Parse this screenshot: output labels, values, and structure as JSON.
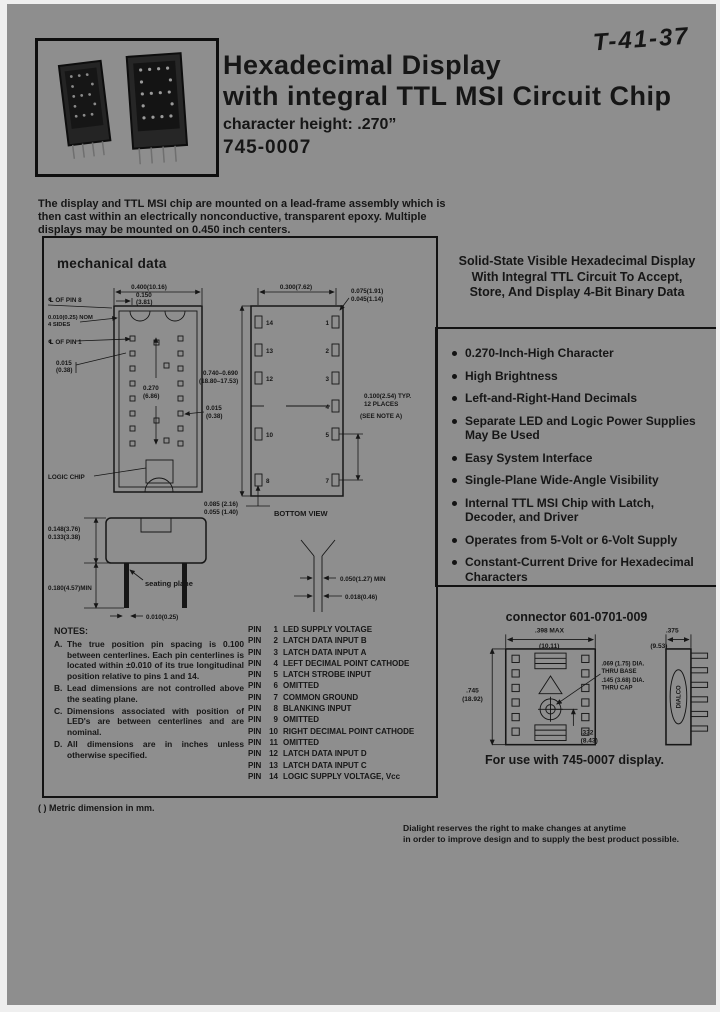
{
  "page": {
    "handwritten_note": "T-41-37",
    "title_line1": "Hexadecimal Display",
    "title_line2": "with integral TTL MSI Circuit Chip",
    "subtitle": "character height: .270”",
    "part_number": "745-0007",
    "intro": "The display and TTL MSI chip are mounted on a lead-frame assembly which is then cast within an electrically nonconductive, transparent epoxy. Multiple displays may be mounted on 0.450 inch centers.",
    "metric_note": "( ) Metric dimension in mm.",
    "disclaimer_line1": "Dialight reserves the right to make changes at anytime",
    "disclaimer_line2": "in order to improve design and to supply the best product possible."
  },
  "headline": {
    "line1": "Solid-State Visible Hexadecimal Display",
    "line2": "With Integral TTL Circuit To Accept,",
    "line3": "Store, And Display 4-Bit Binary Data"
  },
  "features": [
    "0.270-Inch-High Character",
    "High Brightness",
    "Left-and-Right-Hand Decimals",
    "Separate LED and Logic Power Supplies May Be Used",
    "Easy System Interface",
    "Single-Plane Wide-Angle Visibility",
    "Internal TTL MSI Chip with Latch, Decoder, and Driver",
    "Operates from 5-Volt or 6-Volt Supply",
    "Constant-Current Drive for Hexadecimal Characters"
  ],
  "mechanical": {
    "heading": "mechanical data",
    "pin_word": "PIN",
    "front": {
      "dim_width": "0.400(10.16)",
      "dim_offset": "0.150",
      "dim_offset_mm": "(3.81)",
      "cl_pin8": "℄ OF PIN 8",
      "nom1": "0.010(0.25) NOM",
      "nom2": "4 SIDES",
      "cl_pin1": "℄ OF PIN 1",
      "dim_led_row": "0.015",
      "dim_led_row_mm": "(0.38)",
      "dim_char": "0.270",
      "dim_char_mm": "(6.86)",
      "dim_led": "0.015",
      "dim_led_mm": "(0.38)",
      "logic_chip": "LOGIC CHIP"
    },
    "bottom": {
      "dim_span": "0.300(7.62)",
      "dim_pin_a": "0.075(1.91)",
      "dim_pin_b": "0.045(1.14)",
      "dim_body_a": "0.740–0.690",
      "dim_body_b": "(18.80–17.53)",
      "pitch1": "0.100(2.54) TYP.",
      "pitch2": "12 PLACES",
      "pitch3": "(SEE NOTE A)",
      "pad_a": "0.085 (2.16)",
      "pad_b": "0.055 (1.40)",
      "caption": "BOTTOM VIEW",
      "left_pins": [
        "14",
        "13",
        "12",
        "10",
        "8"
      ],
      "right_pins": [
        "1",
        "2",
        "3",
        "4",
        "5",
        "7"
      ]
    },
    "side": {
      "cap_a": "0.148(3.76)",
      "cap_b": "0.133(3.38)",
      "lead_min": "0.180(4.57)MIN",
      "lead_w": "0.010(0.25)",
      "seating": "seating plane"
    },
    "lead": {
      "a": "0.050(1.27) MIN",
      "b": "0.018(0.46)"
    },
    "pins": [
      {
        "n": "1",
        "fn": "LED SUPPLY VOLTAGE"
      },
      {
        "n": "2",
        "fn": "LATCH DATA INPUT B"
      },
      {
        "n": "3",
        "fn": "LATCH DATA INPUT A"
      },
      {
        "n": "4",
        "fn": "LEFT DECIMAL POINT CATHODE"
      },
      {
        "n": "5",
        "fn": "LATCH STROBE INPUT"
      },
      {
        "n": "6",
        "fn": "OMITTED"
      },
      {
        "n": "7",
        "fn": "COMMON GROUND"
      },
      {
        "n": "8",
        "fn": "BLANKING INPUT"
      },
      {
        "n": "9",
        "fn": "OMITTED"
      },
      {
        "n": "10",
        "fn": "RIGHT DECIMAL POINT CATHODE"
      },
      {
        "n": "11",
        "fn": "OMITTED"
      },
      {
        "n": "12",
        "fn": "LATCH DATA INPUT D"
      },
      {
        "n": "13",
        "fn": "LATCH DATA INPUT C"
      },
      {
        "n": "14",
        "fn": "LOGIC SUPPLY VOLTAGE, Vcc"
      }
    ],
    "notes_heading": "NOTES:",
    "notes": [
      {
        "id": "A.",
        "text": "The true position pin spacing is 0.100 between centerlines. Each pin centerlines is located within ±0.010 of its true longitudinal position relative to pins 1 and 14."
      },
      {
        "id": "B.",
        "text": "Lead dimensions are not controlled above the seating plane."
      },
      {
        "id": "C.",
        "text": "Dimensions associated with position of LED's are between centerlines and are nominal."
      },
      {
        "id": "D.",
        "text": "All dimensions are in inches unless otherwise specified."
      }
    ]
  },
  "connector": {
    "title": "connector 601-0701-009",
    "caption": "For use with 745-0007 display.",
    "logo": "DIALCO",
    "dims": {
      "front_w": ".398 MAX",
      "front_w_mm": "(10.11)",
      "side_w": ".375",
      "side_w_mm": "(9.53)",
      "height": ".745",
      "height_mm": "(18.92)",
      "hole_base": ".069 (1.75) DIA.",
      "hole_base2": "THRU BASE",
      "hole_cap": ".145 (3.68) DIA.",
      "hole_cap2": "THRU CAP",
      "center": ".332",
      "center_mm": "(8.43)"
    }
  },
  "colors": {
    "paper": "#8e8e8e",
    "ink": "#161616"
  }
}
